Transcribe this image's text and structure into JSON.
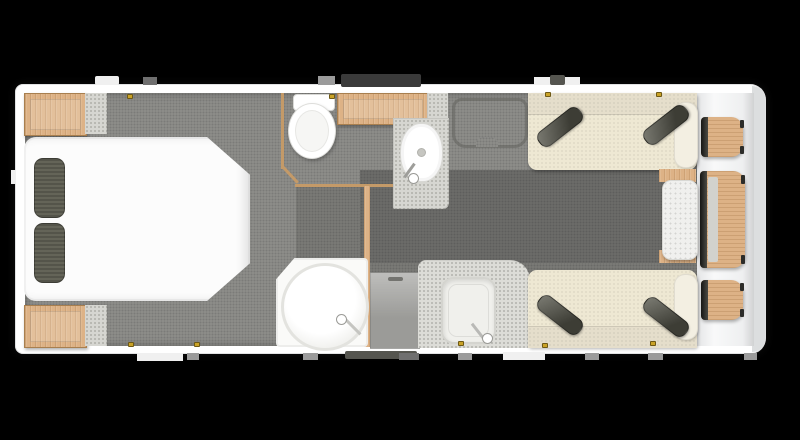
{
  "plan": {
    "type": "floor-plan",
    "subject": "caravan-interior-top-down",
    "zones": [
      {
        "name": "rear-bedroom",
        "items": [
          "island-bed",
          "pillow-left",
          "pillow-right",
          "wardrobe-rear-top",
          "wardrobe-rear-bottom",
          "bedside-shelf-top",
          "bedside-shelf-bottom"
        ]
      },
      {
        "name": "washroom",
        "items": [
          "toilet",
          "vanity-counter",
          "wash-basin",
          "basin-tap",
          "airing-cupboard",
          "shower-cubicle",
          "shower-door-handle"
        ]
      },
      {
        "name": "kitchen",
        "items": [
          "fridge",
          "worktop",
          "kitchen-sink",
          "kitchen-tap"
        ]
      },
      {
        "name": "front-lounge",
        "items": [
          "sofa-top",
          "sofa-bottom",
          "bolster-cushion-top-left",
          "bolster-cushion-top-right",
          "bolster-cushion-bottom-left",
          "bolster-cushion-bottom-right",
          "sofa-arm-top",
          "sofa-arm-bottom",
          "front-chest",
          "chest-wood-trim-top",
          "chest-wood-trim-bottom"
        ]
      },
      {
        "name": "front-lockers",
        "items": [
          "locker-shelf-top",
          "table-leaf-middle",
          "locker-shelf-bottom"
        ]
      },
      {
        "name": "exterior",
        "items": [
          "entrance-door",
          "window-dark-panel",
          "service-hatches",
          "window-catches",
          "entrance-mat"
        ]
      }
    ]
  },
  "palette": {
    "bg": "#000000",
    "shell": "#ffffff",
    "shellEdge": "#d8dadb",
    "front": "#f3f4f5",
    "floor": "#8f8f8c",
    "floorDark": "#7c7c78",
    "floorDarker": "#6e6e6b",
    "wood": "#ddb286",
    "woodDark": "#c49a68",
    "woodEdge": "#a87f4f",
    "bedWhite": "#fcfcfc",
    "pillow": "#646458",
    "sofa": "#eee8d3",
    "sofaBack": "#e5decb",
    "bolster": "#f3efe2",
    "cushion": "#57574c",
    "worktop": "#dcdcd7",
    "speckle": "#d6d6d1",
    "chestWhite": "#f0f0ee",
    "fridge": "#a8a8a5",
    "windowDark": "#3a3a3a",
    "chrome": "#b9b9b6",
    "white": "#ffffff",
    "catch": "#c9a227",
    "tabLight": "#f0f0f0",
    "tabMid": "#9b9b9b",
    "tabDark": "#55554f",
    "tabDark2": "#6f6f6f"
  }
}
